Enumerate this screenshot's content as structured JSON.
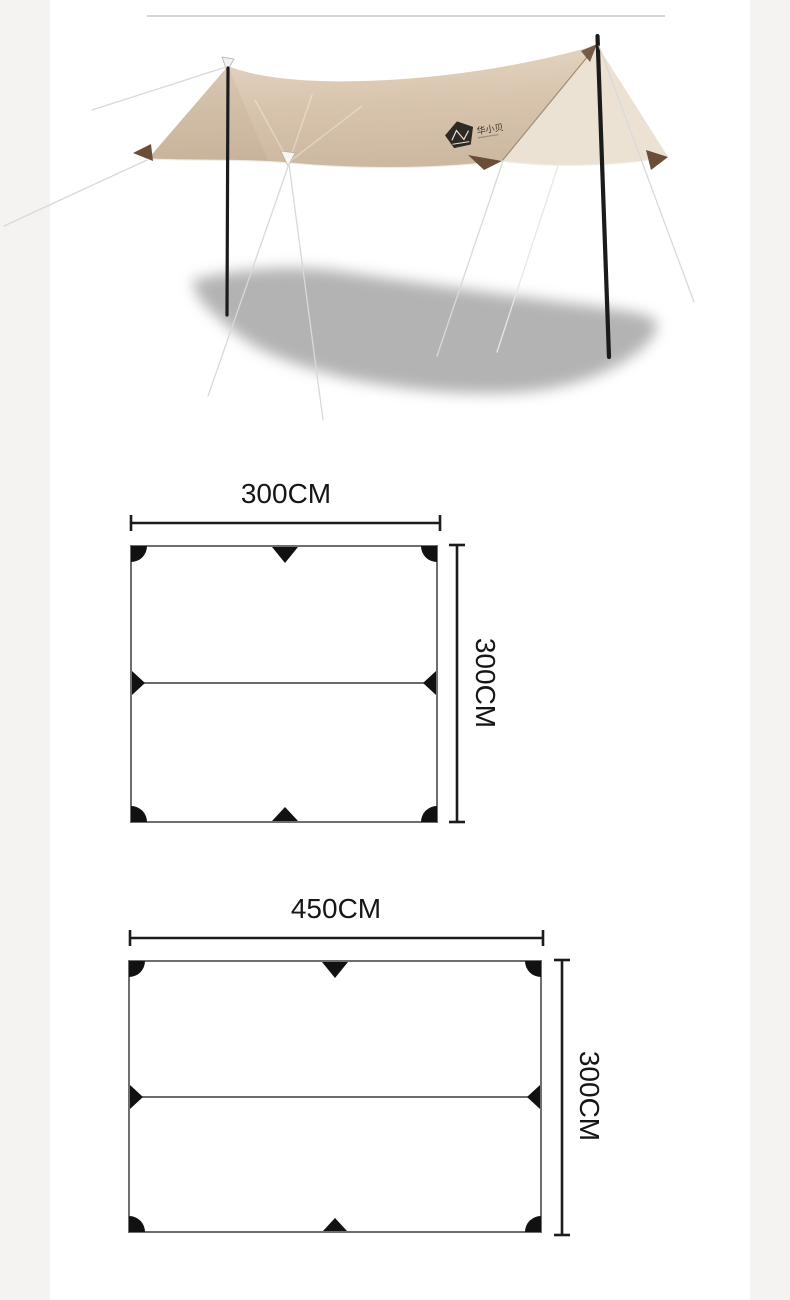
{
  "page": {
    "background_margin_color": "#f4f3f1",
    "content_background_color": "#ffffff",
    "divider_color": "#d7d6d3"
  },
  "product_photo": {
    "description": "Beige camping tarp shelter pitched on two black poles with guy lines and soft ground shadow",
    "logo_text": "华小贝",
    "colors": {
      "canopy_top": "#d8c4ad",
      "canopy_side_panel": "#ebe2d4",
      "corner_patch": "#6a4e3a",
      "pole": "#1b1b1b",
      "shadow": "#a6a6a6",
      "guy_line": "#d9d9d9"
    }
  },
  "diagrams": [
    {
      "width_label": "300CM",
      "height_label": "300CM"
    },
    {
      "width_label": "450CM",
      "height_label": "300CM"
    }
  ]
}
